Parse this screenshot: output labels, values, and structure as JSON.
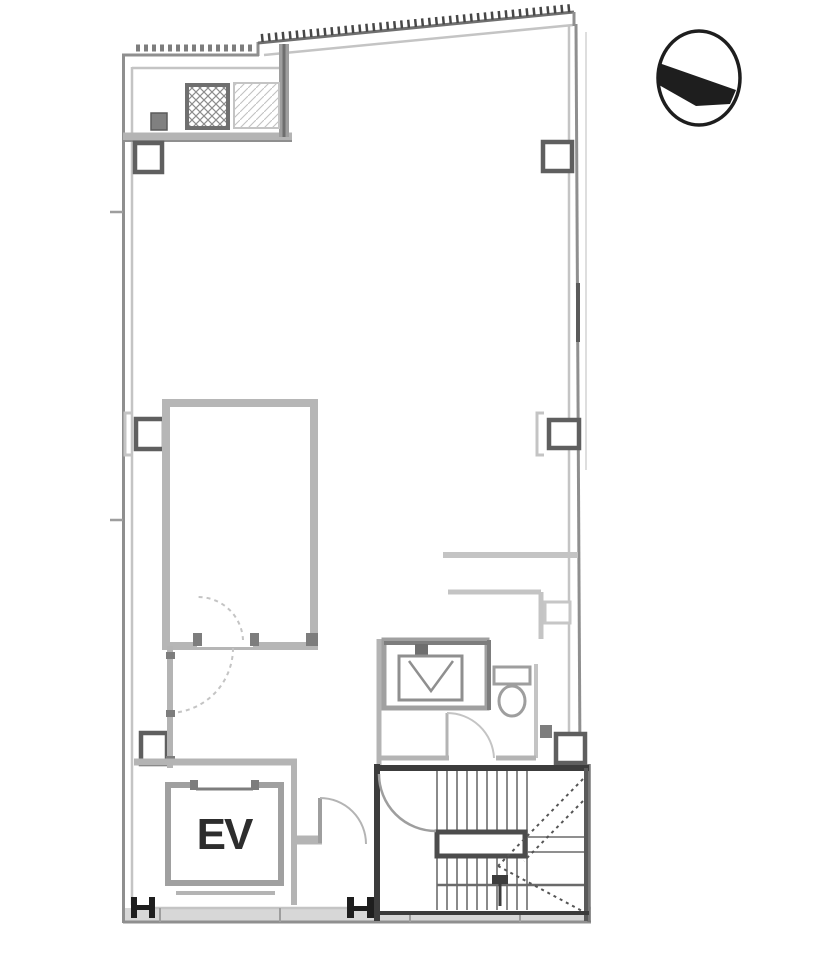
{
  "plan": {
    "elevator_label": "EV"
  },
  "icons": {
    "north_arrow": "north-arrow-icon"
  },
  "colors": {
    "background": "#ffffff",
    "wall_outer": "#8f8f8f",
    "wall_inner": "#c4c4c4",
    "wall_light": "#b4b4b4",
    "wall_mid": "#9e9e9e",
    "wall_dark": "#3c3c3c",
    "detail_dark": "#7d7d7d",
    "hatch": "#8c8c8c",
    "ink": "#1e1e1e",
    "label": "#2d2d2d"
  }
}
